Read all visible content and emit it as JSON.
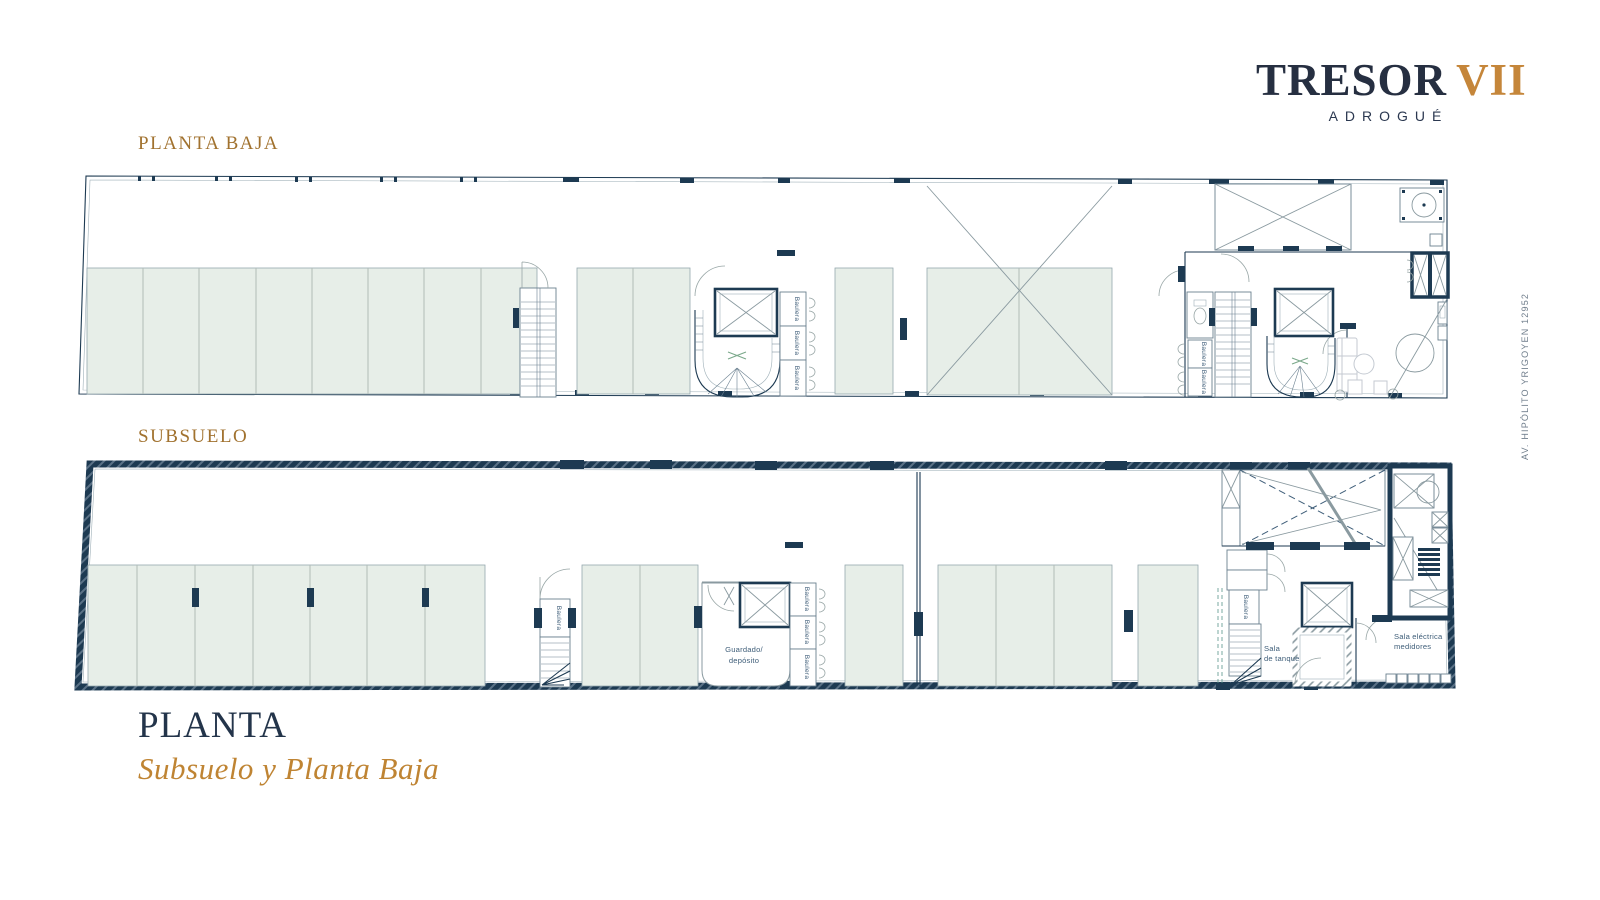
{
  "logo": {
    "name": "TRESOR",
    "numeral": "VII",
    "subtitle": "ADROGUÉ",
    "name_color": "#262f41",
    "numeral_color": "#c5863a"
  },
  "sections": {
    "planta_baja_label": "PLANTA BAJA",
    "subsuelo_label": "SUBSUELO",
    "label_color": "#a1722f"
  },
  "footer": {
    "title": "PLANTA",
    "subtitle": "Subsuelo y Planta Baja",
    "title_color": "#23344a",
    "subtitle_color": "#bf8433"
  },
  "address": {
    "street_label": "AV. HIPÓLITO YRIGOYEN 12952",
    "color": "#707e8c"
  },
  "plan_labels": {
    "baulera": "Baulera",
    "guardado_line1": "Guardado/",
    "guardado_line2": "depósito",
    "sala_tanque_line1": "Sala",
    "sala_tanque_line2": "de tanque",
    "sala_electrica_line1": "Sala eléctrica",
    "sala_electrica_line2": "medidores"
  },
  "colors": {
    "navy": "#1d3a52",
    "gold": "#c5863a",
    "bronze": "#a1722f",
    "stall_green": "#e7eee8",
    "line_gray": "#98a6a6"
  }
}
